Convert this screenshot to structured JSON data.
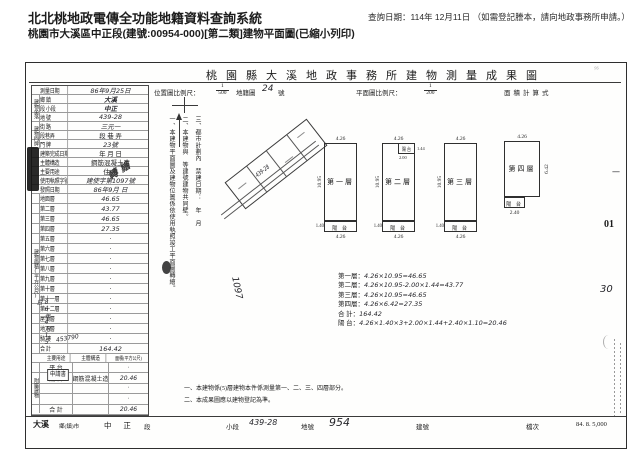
{
  "header": {
    "system_title": "北北桃地政電傳全功能地籍資料查詢系統",
    "query_date": "查詢日期：114年 12月11日",
    "query_note": "（如需登記謄本，請向地政事務所申請。）",
    "subtitle": "桃園市大溪區中正段(建號:00954-000)[第二類]建物平面圖(已縮小列印)"
  },
  "sheet": {
    "title": "桃園縣大溪地政事務所建物測量成果圖",
    "scale_row": {
      "location_scale_label": "位置圖比例尺：",
      "location_scale_num": "1",
      "location_scale_den": "500",
      "cadastral_map_label": "地籍圖",
      "cadastral_map_no": "24",
      "cadastral_map_suffix": "號",
      "plan_scale_label": "平面圖比例尺：",
      "plan_scale_num": "1",
      "plan_scale_den": "200",
      "area_calc_label": "面積計算式"
    },
    "table": {
      "group_labels": {
        "location": "建物坐落",
        "address": "建物門牌",
        "area": "建物面積(平方公尺)",
        "annex": "附屬建物"
      },
      "info_rows": [
        {
          "label": "測量日期",
          "value": "86年9月25日",
          "style": "hw"
        },
        {
          "label": "鄉 鎮",
          "value": "大溪",
          "style": "hwb"
        },
        {
          "label": "段 小段",
          "value": "中正",
          "style": "hwb"
        },
        {
          "label": "地 號",
          "value": "439-28",
          "style": "hw"
        },
        {
          "label": "街 路",
          "value": "三元一",
          "style": "hw"
        },
        {
          "label": "段巷弄",
          "value": "段 巷 弄",
          "style": "print"
        },
        {
          "label": "門 牌",
          "value": "23號",
          "style": "hw"
        },
        {
          "label": "建築完成日期",
          "value": "年 月 日",
          "style": "print"
        },
        {
          "label": "主體構造",
          "value": "鋼筋混凝土造",
          "style": "print"
        },
        {
          "label": "主要用途",
          "value": "住 宅",
          "style": "print"
        },
        {
          "label": "使用執照字號",
          "value": "建使字第1097號",
          "style": "hw"
        },
        {
          "label": "發照日期",
          "value": "86年9月 日",
          "style": "hw"
        }
      ],
      "floor_rows": [
        {
          "label": "地面層",
          "value": "46.65",
          "style": "hw"
        },
        {
          "label": "第二層",
          "value": "43.77",
          "style": "hw"
        },
        {
          "label": "第三層",
          "value": "46.65",
          "style": "hw"
        },
        {
          "label": "第四層",
          "value": "27.35",
          "style": "hw"
        },
        {
          "label": "第五層",
          "value": "·",
          "style": "dot"
        },
        {
          "label": "第六層",
          "value": "·",
          "style": "dot"
        },
        {
          "label": "第七層",
          "value": "·",
          "style": "dot"
        },
        {
          "label": "第八層",
          "value": "·",
          "style": "dot"
        },
        {
          "label": "第九層",
          "value": "·",
          "style": "dot"
        },
        {
          "label": "第十層",
          "value": "·",
          "style": "dot"
        },
        {
          "label": "第十一層",
          "value": "·",
          "style": "dot"
        },
        {
          "label": "第十二層",
          "value": "·",
          "style": "dot"
        },
        {
          "label": "屋頂層",
          "value": "·",
          "style": "dot"
        },
        {
          "label": "地下層",
          "value": "·",
          "style": "dot"
        },
        {
          "label": "騎 樓",
          "value": "·",
          "style": "dot"
        },
        {
          "label": "合 計",
          "value": "164.42",
          "style": "hw"
        }
      ],
      "annex_header": {
        "use": "主要用途",
        "structure": "主體構造",
        "area": "面積(平方公尺)"
      },
      "annex_rows": [
        {
          "use": "平 台",
          "structure": "",
          "area": "·",
          "style": "dot"
        },
        {
          "use": "陽 台",
          "structure": "鋼筋混凝土造",
          "area": "20.46",
          "style": "hw"
        },
        {
          "use": "",
          "structure": "",
          "area": "·",
          "style": "dot"
        },
        {
          "use": "",
          "structure": "",
          "area": "·",
          "style": "dot"
        },
        {
          "use": "合 計",
          "structure": "",
          "area": "20.46",
          "style": "hw"
        }
      ]
    },
    "notes_vertical": [
      {
        "text": "三、都市計劃內 禁建日期： 年 月"
      },
      {
        "text": "二、本建物與 等建號建物共同壁。"
      },
      {
        "text": "一、本建物平面圖及建物位置係依使用執照竣工平面圖轉繪。"
      }
    ],
    "location_map": {
      "parcel_no": "439-28"
    },
    "floor_plans": [
      {
        "label": "第一層",
        "dim_top": "4.26",
        "dim_side": "10.95",
        "dim_bottom": "4.26",
        "balcony_label": "陽 台",
        "balcony_dim": "1.40"
      },
      {
        "label": "第二層",
        "dim_top": "4.26",
        "dim_side": "10.95",
        "dim_bottom": "4.26",
        "balcony_label": "陽 台",
        "balcony_dim": "1.40",
        "top_balcony_label": "陽 台",
        "top_balcony_w": "2.00",
        "top_balcony_d": "1.44"
      },
      {
        "label": "第三層",
        "dim_top": "4.26",
        "dim_side": "10.95",
        "dim_bottom": "4.26",
        "balcony_label": "陽 台",
        "balcony_dim": "1.40"
      },
      {
        "label": "第四層",
        "dim_top": "4.26",
        "dim_side": "6.42",
        "dim_bottom": "2.40",
        "balcony_label": "陽 台"
      }
    ],
    "calc_lines": [
      {
        "label": "第一層：",
        "formula": "4.26×10.95=46.65"
      },
      {
        "label": "第二層：",
        "formula": "4.26×10.95-2.00×1.44=43.77"
      },
      {
        "label": "第三層：",
        "formula": "4.26×10.95=46.65"
      },
      {
        "label": "第四層：",
        "formula": "4.26×6.42=27.35"
      },
      {
        "label": "合 計：",
        "formula": "164.42"
      },
      {
        "label": "陽 台：",
        "formula": "4.26×1.40×3+2.00×1.44+2.40×1.10=20.46"
      }
    ],
    "bottom_notes": [
      "一、本建物係(5)層建物本件係測量第一、二、三、四層部分。",
      "二、本成果圖應以建物登記為準。"
    ],
    "stamps": {
      "received_date": "86年4月15日",
      "received_no": "453790",
      "application_box": "申請書",
      "stamp_fragment": "轉繪",
      "license_no_hand": "1097"
    },
    "margin_marks": {
      "mark1": "01",
      "mark2": "30",
      "dash": "—"
    },
    "bottom_strip": {
      "township": "大溪",
      "township_label": "鄉(鎮)市",
      "section": "中 正",
      "section_label": "段",
      "subsection_label": "小段",
      "lot_no_hand": "439-28",
      "lot_label": "地號",
      "building_no_hand": "954",
      "building_label": "建號",
      "file_label": "檔次",
      "print_info": "84. 8. 5,000"
    }
  },
  "colors": {
    "ink": "#1c1c1c",
    "handwriting": "#26262b",
    "faint": "#a8a8a8",
    "stamp_dark": "#141414"
  }
}
